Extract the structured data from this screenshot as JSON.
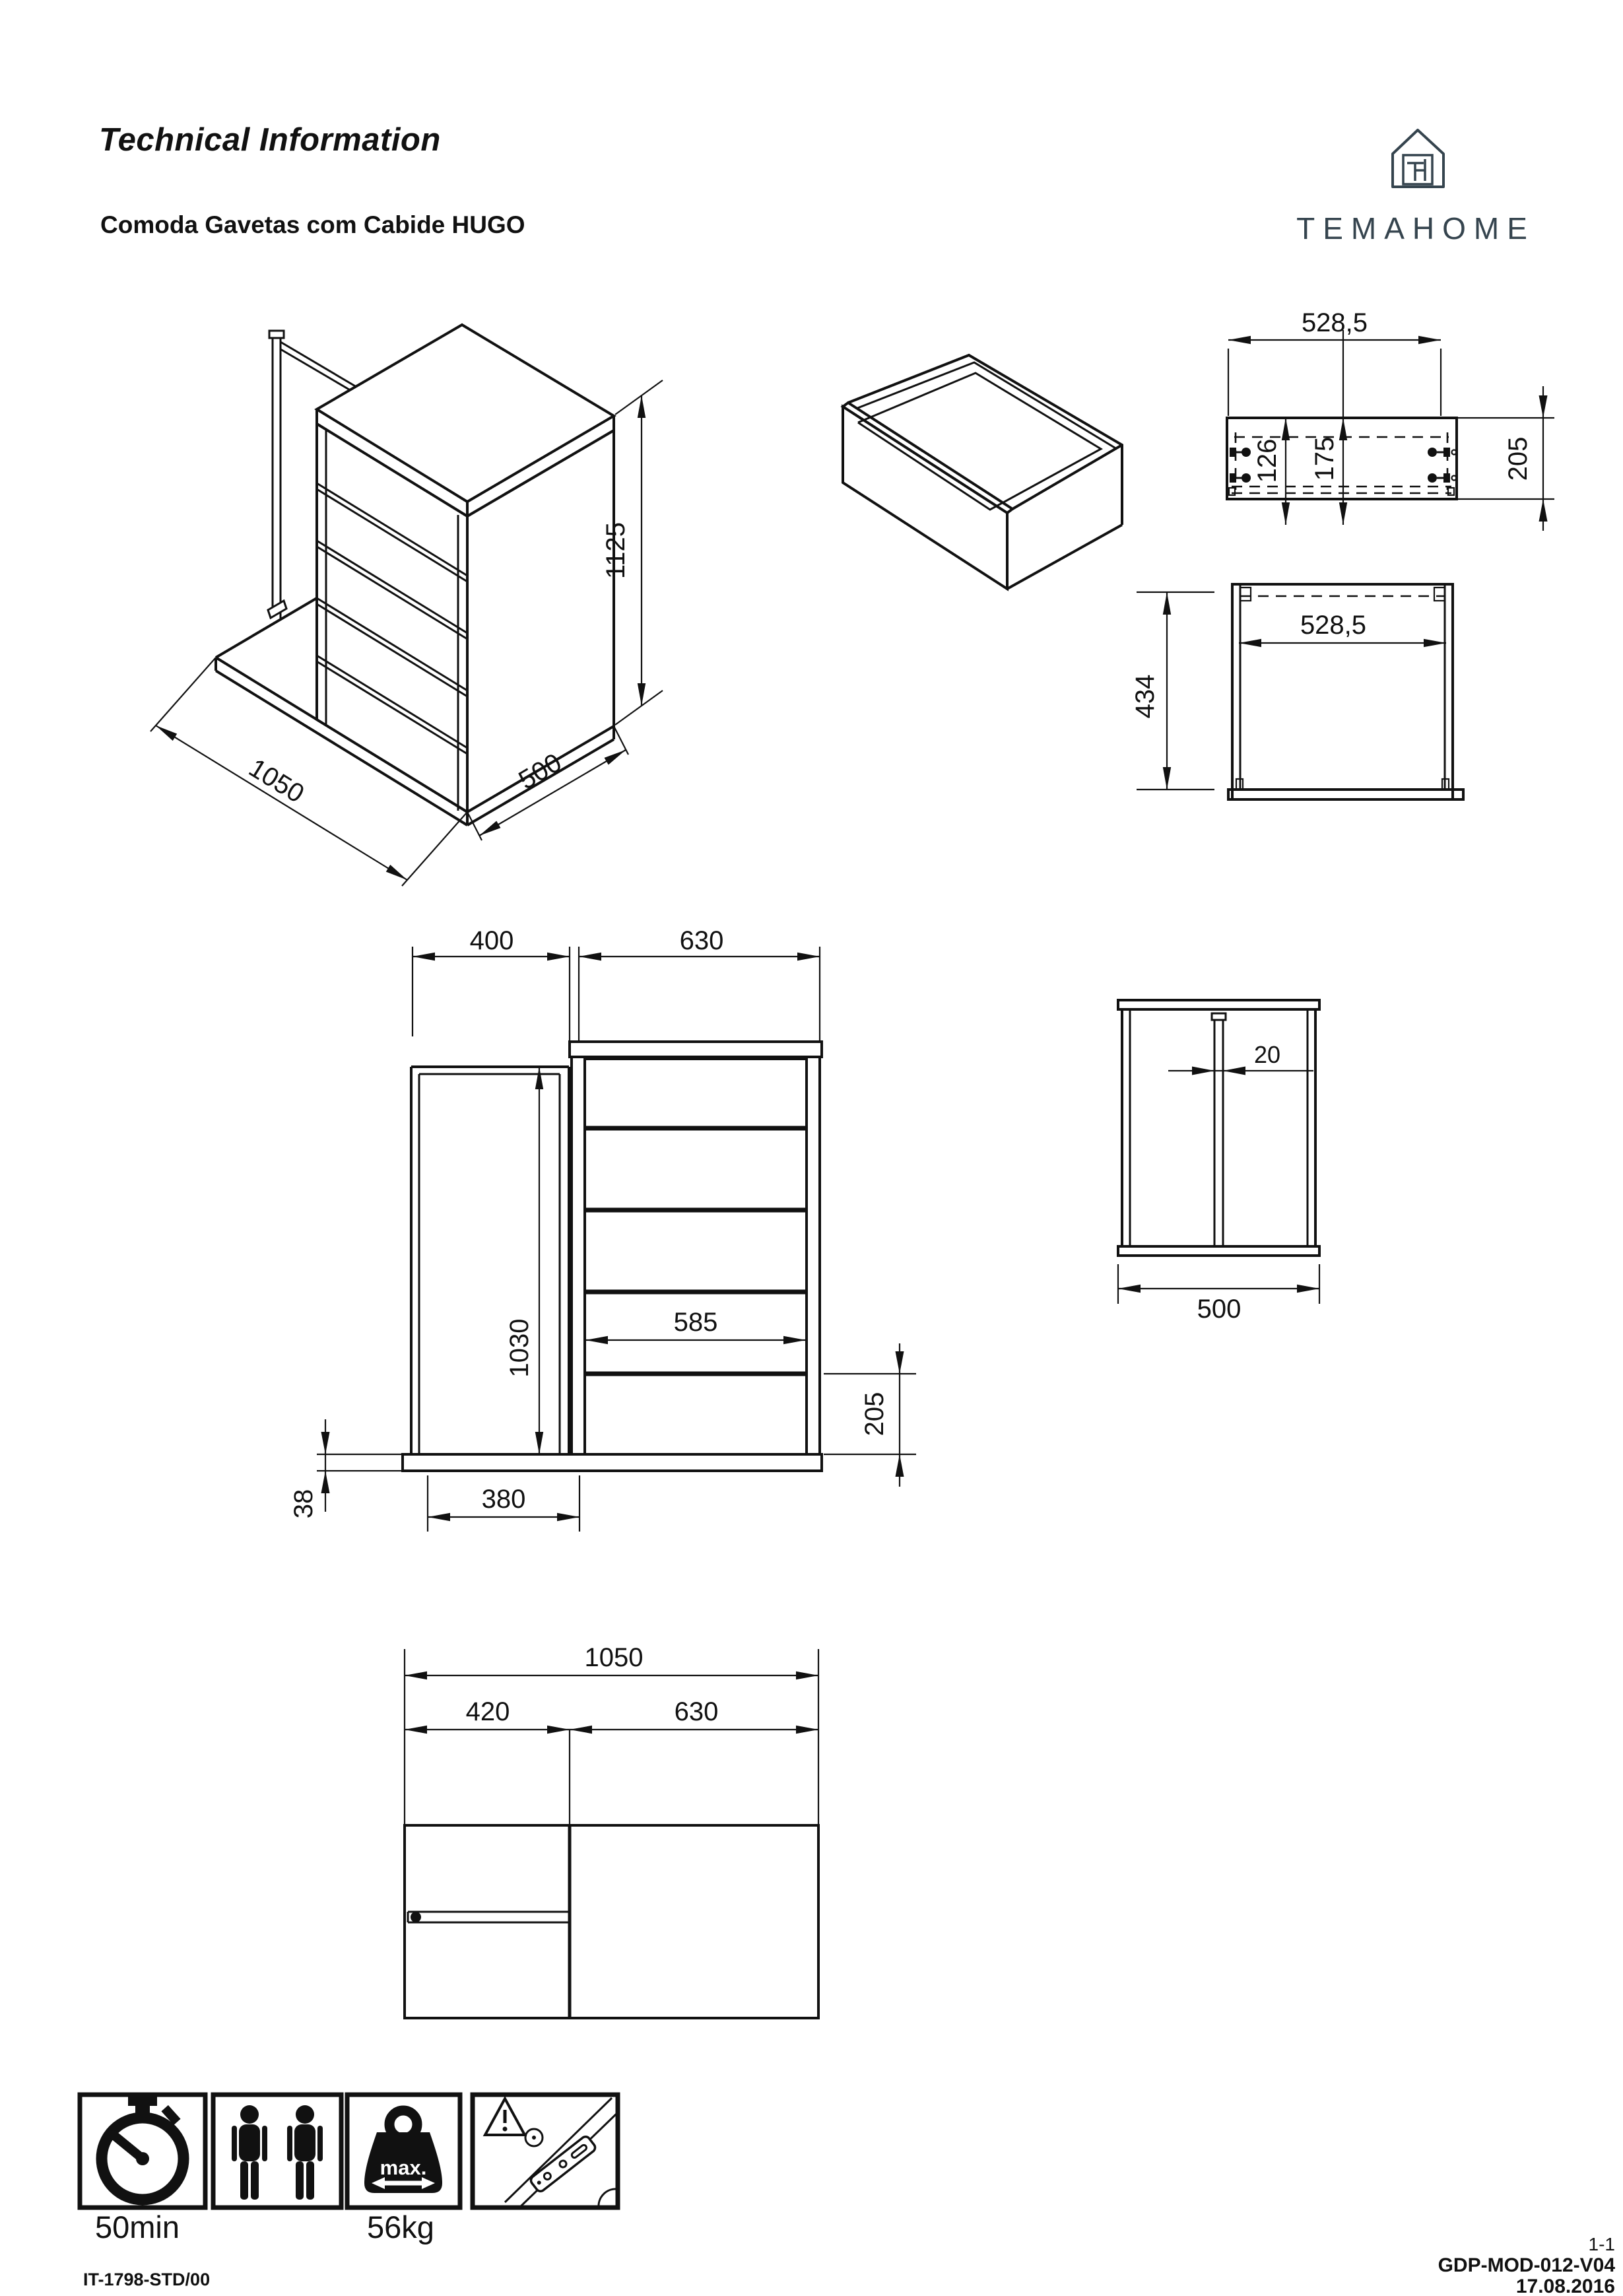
{
  "header": {
    "title": "Technical Information",
    "subtitle": "Comoda Gavetas com Cabide HUGO"
  },
  "brand": {
    "name": "TEMAHOME",
    "color": "#35444e"
  },
  "views": {
    "iso_assembly": {
      "height": "1125",
      "width": "1050",
      "depth": "500"
    },
    "drawer_front": {
      "width": "528,5",
      "dim_top": "126",
      "dim_mid": "175",
      "height": "205"
    },
    "drawer_plan": {
      "width": "528,5",
      "depth": "434"
    },
    "front": {
      "rail_width": "400",
      "chest_width": "630",
      "rail_inner_height": "1030",
      "drawer_width": "585",
      "drawer_front_height": "205",
      "base_thickness": "38",
      "base_left_width": "380"
    },
    "side": {
      "rail_thickness": "20",
      "depth": "500"
    },
    "plan": {
      "total_width": "1050",
      "rail_section": "420",
      "chest_section": "630"
    }
  },
  "icons": {
    "time_label": "50min",
    "weight_label": "56kg",
    "weight_badge": "max."
  },
  "footer": {
    "document": "IT-1798-STD/00",
    "page": "1-1",
    "reference": "GDP-MOD-012-V04",
    "date": "17.08.2016"
  }
}
